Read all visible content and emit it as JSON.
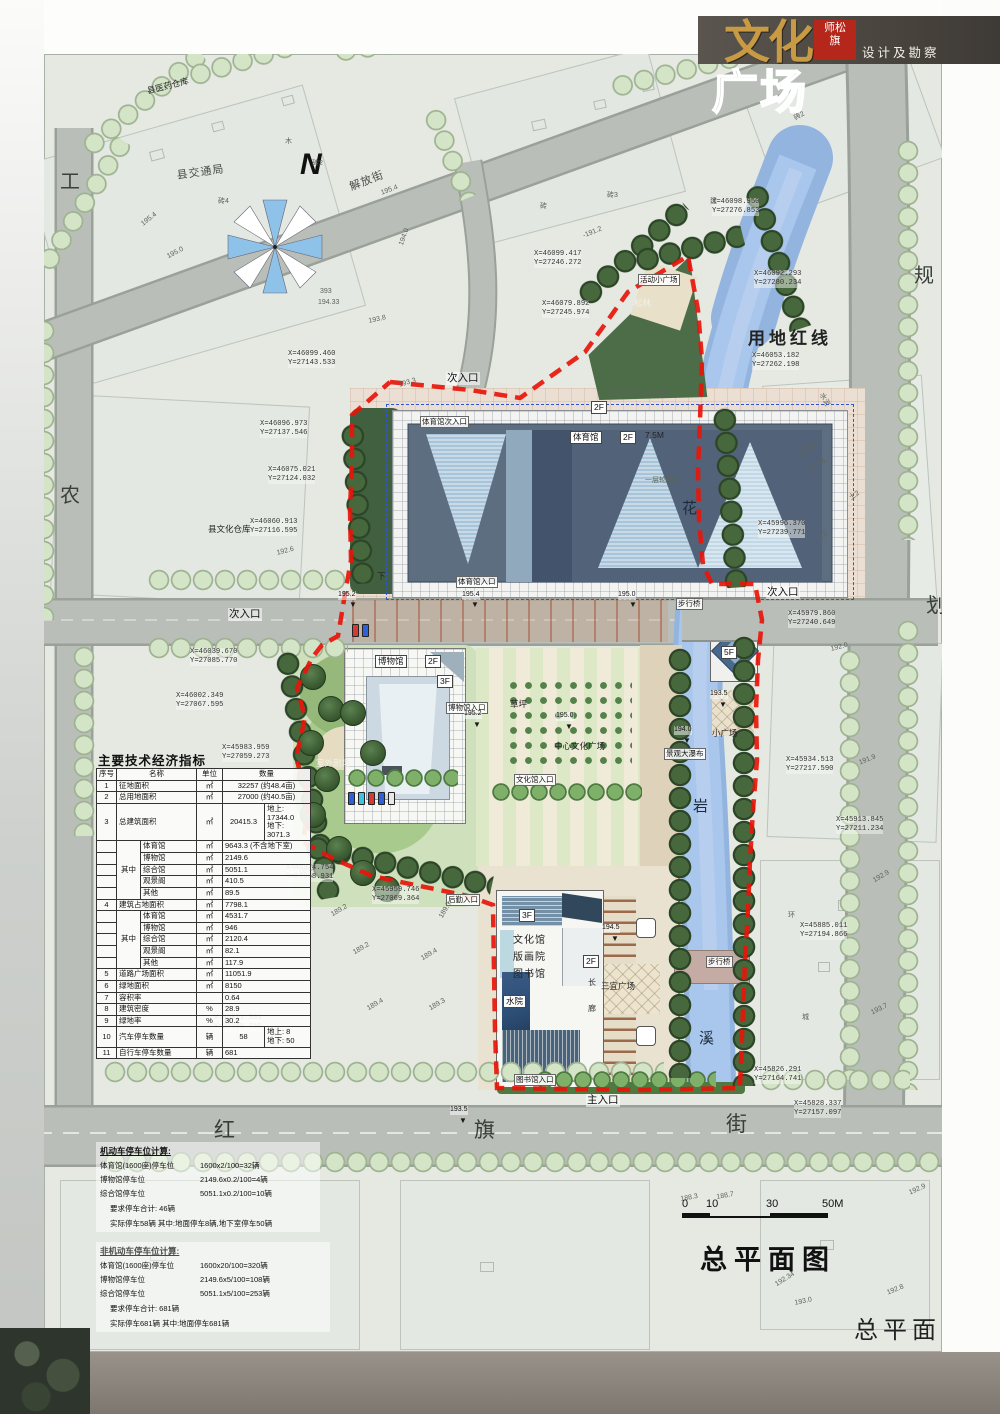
{
  "header": {
    "logo_top": "文化",
    "logo_bottom": "广场",
    "stamp": "师松\n旗",
    "subtitle": "设计及勘察"
  },
  "titles": {
    "plan_title": "总平面图",
    "margin_title": "总平面"
  },
  "scale": {
    "t0": "0",
    "t1": "10",
    "t2": "30",
    "t3": "50M"
  },
  "colors": {
    "boundary_red": "#e8150a",
    "river_blue": "#a9c6ec",
    "road_grey": "#b9bfb8",
    "tree_light": "#d4e4c6",
    "tree_dark": "#46683c",
    "logo_gold": "#c89a43",
    "stamp_red": "#b5271b",
    "header_bar": "#4f4a44"
  },
  "table": {
    "title": "主要技术经济指标",
    "rows": [
      [
        {
          "t": "序号"
        },
        {
          "t": "名称",
          "cs": 2
        },
        {
          "t": "单位"
        },
        {
          "t": "数量",
          "cs": 2
        }
      ],
      [
        {
          "t": "1"
        },
        {
          "t": "征地面积",
          "cs": 2,
          "cls": "l"
        },
        {
          "t": "㎡"
        },
        {
          "t": "32257 (约48.4亩)",
          "cs": 2
        }
      ],
      [
        {
          "t": "2"
        },
        {
          "t": "总用地面积",
          "cs": 2,
          "cls": "l"
        },
        {
          "t": "㎡"
        },
        {
          "t": "27000 (约40.5亩)",
          "cs": 2
        }
      ],
      [
        {
          "t": "3"
        },
        {
          "t": "总建筑面积",
          "cs": 2,
          "cls": "l"
        },
        {
          "t": "㎡"
        },
        {
          "t": "20415.3"
        },
        {
          "t": "地上: 17344.0\n地下: 3071.3",
          "cls": "l"
        }
      ],
      [
        {
          "t": ""
        },
        {
          "t": "其中",
          "rs": 5
        },
        {
          "t": "体育馆",
          "cls": "l"
        },
        {
          "t": "㎡"
        },
        {
          "t": "9643.3 (不含地下室)",
          "cs": 2,
          "cls": "l"
        }
      ],
      [
        {
          "t": ""
        },
        {
          "t": "博物馆",
          "cls": "l"
        },
        {
          "t": "㎡"
        },
        {
          "t": "2149.6",
          "cs": 2,
          "cls": "l"
        }
      ],
      [
        {
          "t": ""
        },
        {
          "t": "综合馆",
          "cls": "l"
        },
        {
          "t": "㎡"
        },
        {
          "t": "5051.1",
          "cs": 2,
          "cls": "l"
        }
      ],
      [
        {
          "t": ""
        },
        {
          "t": "观景阁",
          "cls": "l"
        },
        {
          "t": "㎡"
        },
        {
          "t": "410.5",
          "cs": 2,
          "cls": "l"
        }
      ],
      [
        {
          "t": ""
        },
        {
          "t": "其他",
          "cls": "l"
        },
        {
          "t": "㎡"
        },
        {
          "t": "89.5",
          "cs": 2,
          "cls": "l"
        }
      ],
      [
        {
          "t": "4"
        },
        {
          "t": "建筑占地面积",
          "cs": 2,
          "cls": "l"
        },
        {
          "t": "㎡"
        },
        {
          "t": "7798.1",
          "cs": 2,
          "cls": "l"
        }
      ],
      [
        {
          "t": ""
        },
        {
          "t": "其中",
          "rs": 5
        },
        {
          "t": "体育馆",
          "cls": "l"
        },
        {
          "t": "㎡"
        },
        {
          "t": "4531.7",
          "cs": 2,
          "cls": "l"
        }
      ],
      [
        {
          "t": ""
        },
        {
          "t": "博物馆",
          "cls": "l"
        },
        {
          "t": "㎡"
        },
        {
          "t": "946",
          "cs": 2,
          "cls": "l"
        }
      ],
      [
        {
          "t": ""
        },
        {
          "t": "综合馆",
          "cls": "l"
        },
        {
          "t": "㎡"
        },
        {
          "t": "2120.4",
          "cs": 2,
          "cls": "l"
        }
      ],
      [
        {
          "t": ""
        },
        {
          "t": "观景阁",
          "cls": "l"
        },
        {
          "t": "㎡"
        },
        {
          "t": "82.1",
          "cs": 2,
          "cls": "l"
        }
      ],
      [
        {
          "t": ""
        },
        {
          "t": "其他",
          "cls": "l"
        },
        {
          "t": "㎡"
        },
        {
          "t": "117.9",
          "cs": 2,
          "cls": "l"
        }
      ],
      [
        {
          "t": "5"
        },
        {
          "t": "道路广场面积",
          "cs": 2,
          "cls": "l"
        },
        {
          "t": "㎡"
        },
        {
          "t": "11051.9",
          "cs": 2,
          "cls": "l"
        }
      ],
      [
        {
          "t": "6"
        },
        {
          "t": "绿地面积",
          "cs": 2,
          "cls": "l"
        },
        {
          "t": "㎡"
        },
        {
          "t": "8150",
          "cs": 2,
          "cls": "l"
        }
      ],
      [
        {
          "t": "7"
        },
        {
          "t": "容积率",
          "cs": 2,
          "cls": "l"
        },
        {
          "t": ""
        },
        {
          "t": "0.64",
          "cs": 2,
          "cls": "l"
        }
      ],
      [
        {
          "t": "8"
        },
        {
          "t": "建筑密度",
          "cs": 2,
          "cls": "l"
        },
        {
          "t": "%"
        },
        {
          "t": "28.9",
          "cs": 2,
          "cls": "l"
        }
      ],
      [
        {
          "t": "9"
        },
        {
          "t": "绿地率",
          "cs": 2,
          "cls": "l"
        },
        {
          "t": "%"
        },
        {
          "t": "30.2",
          "cs": 2,
          "cls": "l"
        }
      ],
      [
        {
          "t": "10"
        },
        {
          "t": "汽车停车数量",
          "cs": 2,
          "cls": "l"
        },
        {
          "t": "辆"
        },
        {
          "t": "58"
        },
        {
          "t": "地上:  8\n地下:  50",
          "cls": "l"
        }
      ],
      [
        {
          "t": "11"
        },
        {
          "t": "自行车停车数量",
          "cs": 2,
          "cls": "l"
        },
        {
          "t": "辆"
        },
        {
          "t": "681",
          "cs": 2,
          "cls": "l"
        }
      ]
    ]
  },
  "parking": {
    "motor_title": "机动车停车位计算:",
    "motor": [
      [
        "体育馆(1600座)停车位",
        "1600x2/100=32辆"
      ],
      [
        "博物馆停车位",
        "2149.6x0.2/100=4辆"
      ],
      [
        "综合馆停车位",
        "5051.1x0.2/100=10辆"
      ]
    ],
    "motor_total": "要求停车合计:  46辆",
    "motor_actual": "实际停车58辆  其中:地面停车8辆,地下室停车50辆",
    "nonmotor_title": "非机动车停车位计算:",
    "nonmotor": [
      [
        "体育馆(1600座)停车位",
        "1600x20/100=320辆"
      ],
      [
        "博物馆停车位",
        "2149.6x5/100=108辆"
      ],
      [
        "综合馆停车位",
        "5051.1x5/100=253辆"
      ]
    ],
    "nonmotor_total": "要求停车合计:  681辆",
    "nonmotor_actual": "实际停车681辆  其中:地面停车681辆"
  },
  "annotations": [
    {
      "t": "工",
      "x": 60,
      "y": 170,
      "c": "mar"
    },
    {
      "t": "农",
      "x": 60,
      "y": 484,
      "c": "mar"
    },
    {
      "t": "规",
      "x": 914,
      "y": 264,
      "c": "mar"
    },
    {
      "t": "划",
      "x": 926,
      "y": 594,
      "c": "mar"
    },
    {
      "t": "红",
      "x": 214,
      "y": 1118,
      "c": "street"
    },
    {
      "t": "旗",
      "x": 474,
      "y": 1118,
      "c": "street"
    },
    {
      "t": "街",
      "x": 726,
      "y": 1112,
      "c": "street"
    },
    {
      "t": "解放街",
      "x": 348,
      "y": 182,
      "r": -21,
      "c": "rd"
    },
    {
      "t": "N",
      "x": 300,
      "y": 146,
      "c": "north",
      "n": "north-letter"
    },
    {
      "t": "县交通局",
      "x": 176,
      "y": 170,
      "r": -8,
      "c": "rd"
    },
    {
      "t": "县医药仓库",
      "x": 146,
      "y": 86,
      "r": -14,
      "c": "s9"
    },
    {
      "t": "县文化仓库",
      "x": 208,
      "y": 524,
      "c": "s9"
    },
    {
      "t": "用地红线",
      "x": 748,
      "y": 328,
      "c": "big",
      "n": "red-line-label"
    },
    {
      "t": "次入口",
      "x": 446,
      "y": 372,
      "c": "ent"
    },
    {
      "t": "次入口",
      "x": 228,
      "y": 608,
      "c": "ent"
    },
    {
      "t": "次入口",
      "x": 766,
      "y": 586,
      "c": "ent"
    },
    {
      "t": "主入口",
      "x": 586,
      "y": 1094,
      "c": "ent"
    },
    {
      "t": "体育馆次入口",
      "x": 420,
      "y": 416,
      "c": "tb"
    },
    {
      "t": "体育馆入口",
      "x": 456,
      "y": 576,
      "c": "tb"
    },
    {
      "t": "博物馆入口",
      "x": 446,
      "y": 702,
      "c": "tb"
    },
    {
      "t": "文化馆入口",
      "x": 514,
      "y": 774,
      "c": "tb"
    },
    {
      "t": "图书馆入口",
      "x": 514,
      "y": 1074,
      "c": "tb"
    },
    {
      "t": "后勤入口",
      "x": 446,
      "y": 894,
      "c": "tb"
    },
    {
      "t": "步行桥",
      "x": 676,
      "y": 598,
      "c": "tb"
    },
    {
      "t": "步行桥",
      "x": 706,
      "y": 956,
      "c": "tb"
    },
    {
      "t": "景观大瀑布",
      "x": 664,
      "y": 748,
      "c": "tb"
    },
    {
      "t": "活动小广场",
      "x": 638,
      "y": 274,
      "c": "tb"
    },
    {
      "t": "松林",
      "x": 634,
      "y": 298,
      "c": "s9w"
    },
    {
      "t": "体育馆",
      "x": 570,
      "y": 431,
      "c": "box"
    },
    {
      "t": "2F",
      "x": 620,
      "y": 431,
      "c": "box"
    },
    {
      "t": "7.5M",
      "x": 645,
      "y": 430,
      "c": "s9"
    },
    {
      "t": "2F",
      "x": 591,
      "y": 401,
      "c": "box"
    },
    {
      "t": "地下室顶面线 9.5M",
      "x": 608,
      "y": 390,
      "c": "s"
    },
    {
      "t": "一层轮廓线",
      "x": 645,
      "y": 477,
      "c": "s"
    },
    {
      "t": "下",
      "x": 377,
      "y": 571,
      "c": "s9"
    },
    {
      "t": "博物馆",
      "x": 375,
      "y": 655,
      "c": "box"
    },
    {
      "t": "2F",
      "x": 425,
      "y": 655,
      "c": "box"
    },
    {
      "t": "3F",
      "x": 437,
      "y": 675,
      "c": "box"
    },
    {
      "t": "草坪",
      "x": 510,
      "y": 699,
      "c": "s9"
    },
    {
      "t": "室外剧场",
      "x": 316,
      "y": 758,
      "c": "s9w"
    },
    {
      "t": "中心文化广场",
      "x": 554,
      "y": 741,
      "c": "s9"
    },
    {
      "t": "文化馆",
      "x": 513,
      "y": 935,
      "c": "bldl"
    },
    {
      "t": "版画院",
      "x": 513,
      "y": 952,
      "c": "bldl"
    },
    {
      "t": "图书馆",
      "x": 513,
      "y": 969,
      "c": "bldl"
    },
    {
      "t": "3F",
      "x": 519,
      "y": 909,
      "c": "box"
    },
    {
      "t": "2F",
      "x": 583,
      "y": 955,
      "c": "box"
    },
    {
      "t": "水院",
      "x": 503,
      "y": 995,
      "c": "box"
    },
    {
      "t": "三宜广场",
      "x": 601,
      "y": 981,
      "c": "s9"
    },
    {
      "t": "小广场",
      "x": 712,
      "y": 728,
      "c": "s9"
    },
    {
      "t": "5F",
      "x": 721,
      "y": 646,
      "c": "box"
    },
    {
      "t": "长",
      "x": 588,
      "y": 978,
      "c": "s8"
    },
    {
      "t": "廊",
      "x": 588,
      "y": 1004,
      "c": "s8"
    },
    {
      "t": "花",
      "x": 682,
      "y": 500,
      "c": "river"
    },
    {
      "t": "岩",
      "x": 693,
      "y": 798,
      "c": "river"
    },
    {
      "t": "溪",
      "x": 699,
      "y": 1030,
      "c": "river"
    },
    {
      "t": "环",
      "x": 788,
      "y": 912,
      "c": "s"
    },
    {
      "t": "城",
      "x": 802,
      "y": 1014,
      "c": "s"
    },
    {
      "t": "195.2",
      "x": 338,
      "y": 591,
      "c": "lv"
    },
    {
      "t": "▼",
      "x": 349,
      "y": 600,
      "c": "mk"
    },
    {
      "t": "195.4",
      "x": 462,
      "y": 591,
      "c": "lv"
    },
    {
      "t": "▼",
      "x": 471,
      "y": 600,
      "c": "mk"
    },
    {
      "t": "195.0",
      "x": 618,
      "y": 591,
      "c": "lv"
    },
    {
      "t": "▼",
      "x": 629,
      "y": 600,
      "c": "mk"
    },
    {
      "t": "195.2",
      "x": 464,
      "y": 710,
      "c": "lv"
    },
    {
      "t": "▼",
      "x": 473,
      "y": 720,
      "c": "mk"
    },
    {
      "t": "195.0",
      "x": 556,
      "y": 712,
      "c": "lv"
    },
    {
      "t": "▼",
      "x": 565,
      "y": 722,
      "c": "mk"
    },
    {
      "t": "194.5",
      "x": 602,
      "y": 924,
      "c": "lv"
    },
    {
      "t": "▼",
      "x": 611,
      "y": 934,
      "c": "mk"
    },
    {
      "t": "193.5",
      "x": 710,
      "y": 690,
      "c": "lv"
    },
    {
      "t": "▼",
      "x": 719,
      "y": 700,
      "c": "mk"
    },
    {
      "t": "194.0",
      "x": 674,
      "y": 726,
      "c": "lv"
    },
    {
      "t": "▼",
      "x": 683,
      "y": 736,
      "c": "mk"
    },
    {
      "t": "193.5",
      "x": 450,
      "y": 1106,
      "c": "lv"
    },
    {
      "t": "▼",
      "x": 459,
      "y": 1116,
      "c": "mk"
    },
    {
      "t": "X=46098.950\nY=27276.853",
      "x": 712,
      "y": 198,
      "c": "c"
    },
    {
      "t": "X=46099.417\nY=27246.272",
      "x": 534,
      "y": 250,
      "c": "c"
    },
    {
      "t": "X=46092.293\nY=27280.234",
      "x": 754,
      "y": 270,
      "c": "c"
    },
    {
      "t": "X=46079.892\nY=27245.974",
      "x": 542,
      "y": 300,
      "c": "c"
    },
    {
      "t": "X=46053.182\nY=27262.198",
      "x": 752,
      "y": 352,
      "c": "c"
    },
    {
      "t": "X=46099.460\nY=27143.533",
      "x": 288,
      "y": 350,
      "c": "c"
    },
    {
      "t": "X=46096.973\nY=27137.546",
      "x": 260,
      "y": 420,
      "c": "c"
    },
    {
      "t": "X=46075.021\nY=27124.032",
      "x": 268,
      "y": 466,
      "c": "c"
    },
    {
      "t": "X=46060.913\nY=27116.595",
      "x": 250,
      "y": 518,
      "c": "c"
    },
    {
      "t": "X=46039.670\nY=27085.770",
      "x": 190,
      "y": 648,
      "c": "c"
    },
    {
      "t": "X=46002.349\nY=27067.595",
      "x": 176,
      "y": 692,
      "c": "c"
    },
    {
      "t": "X=45983.959\nY=27059.273",
      "x": 222,
      "y": 744,
      "c": "c"
    },
    {
      "t": "X=45974.754\nY=27068.931",
      "x": 286,
      "y": 864,
      "c": "c"
    },
    {
      "t": "X=45959.746\nY=27069.364",
      "x": 372,
      "y": 886,
      "c": "c"
    },
    {
      "t": "X=45996.370\nY=27239.771",
      "x": 758,
      "y": 520,
      "c": "c"
    },
    {
      "t": "X=45979.860\nY=27240.649",
      "x": 788,
      "y": 610,
      "c": "c"
    },
    {
      "t": "X=45934.513\nY=27217.590",
      "x": 786,
      "y": 756,
      "c": "c"
    },
    {
      "t": "X=45913.845\nY=27211.234",
      "x": 836,
      "y": 816,
      "c": "c"
    },
    {
      "t": "X=45885.011\nY=27194.866",
      "x": 800,
      "y": 922,
      "c": "c"
    },
    {
      "t": "X=45871.385\nY=27085.755",
      "x": 214,
      "y": 1014,
      "c": "c"
    },
    {
      "t": "X=45826.291\nY=27164.741",
      "x": 754,
      "y": 1066,
      "c": "c"
    },
    {
      "t": "X=45828.337\nY=27157.097",
      "x": 794,
      "y": 1100,
      "c": "c"
    },
    {
      "t": "砖4",
      "x": 218,
      "y": 198,
      "c": "s"
    },
    {
      "t": "砖2",
      "x": 312,
      "y": 160,
      "c": "s"
    },
    {
      "t": "木",
      "x": 285,
      "y": 138,
      "c": "s"
    },
    {
      "t": "195.4",
      "x": 140,
      "y": 222,
      "r": -38,
      "c": "s"
    },
    {
      "t": "195.0",
      "x": 166,
      "y": 254,
      "r": -28,
      "c": "s"
    },
    {
      "t": "195.4",
      "x": 380,
      "y": 190,
      "r": -20,
      "c": "s"
    },
    {
      "t": "194.0",
      "x": 398,
      "y": 244,
      "r": -70,
      "c": "s"
    },
    {
      "t": "393",
      "x": 320,
      "y": 288,
      "c": "s"
    },
    {
      "t": "194.33",
      "x": 318,
      "y": 299,
      "c": "s"
    },
    {
      "t": "193.8",
      "x": 368,
      "y": 318,
      "r": -12,
      "c": "s"
    },
    {
      "t": "砖",
      "x": 540,
      "y": 203,
      "c": "s"
    },
    {
      "t": "砖3",
      "x": 607,
      "y": 192,
      "c": "s"
    },
    {
      "t": "建",
      "x": 710,
      "y": 198,
      "c": "s"
    },
    {
      "t": "-191.2",
      "x": 582,
      "y": 233,
      "r": -22,
      "c": "s"
    },
    {
      "t": "砖2",
      "x": 793,
      "y": 116,
      "r": -30,
      "c": "s"
    },
    {
      "t": "192.6",
      "x": 276,
      "y": 550,
      "r": -14,
      "c": "s"
    },
    {
      "t": "193.3",
      "x": 398,
      "y": 382,
      "r": -16,
      "c": "s"
    },
    {
      "t": "192.0",
      "x": 830,
      "y": 646,
      "r": -14,
      "c": "s"
    },
    {
      "t": "191.9",
      "x": 858,
      "y": 760,
      "r": -22,
      "c": "s"
    },
    {
      "t": "192.95",
      "x": 806,
      "y": 470,
      "r": -36,
      "c": "s"
    },
    {
      "t": "4-D339",
      "x": 798,
      "y": 452,
      "r": -36,
      "c": "s"
    },
    {
      "t": "水泥",
      "x": 824,
      "y": 392,
      "r": 62,
      "c": "s"
    },
    {
      "t": "土2",
      "x": 848,
      "y": 496,
      "r": -35,
      "c": "s"
    },
    {
      "t": "土2",
      "x": 816,
      "y": 536,
      "r": -35,
      "c": "s"
    },
    {
      "t": "192.9",
      "x": 872,
      "y": 878,
      "r": -30,
      "c": "s"
    },
    {
      "t": "193.7",
      "x": 870,
      "y": 1010,
      "r": -26,
      "c": "s"
    },
    {
      "t": "188.3",
      "x": 680,
      "y": 1196,
      "r": -10,
      "c": "s"
    },
    {
      "t": "188.7",
      "x": 716,
      "y": 1194,
      "r": -10,
      "c": "s"
    },
    {
      "t": "192.34",
      "x": 774,
      "y": 1282,
      "r": -32,
      "c": "s"
    },
    {
      "t": "193.0",
      "x": 794,
      "y": 1300,
      "r": -12,
      "c": "s"
    },
    {
      "t": "192.8",
      "x": 886,
      "y": 1290,
      "r": -22,
      "c": "s"
    },
    {
      "t": "192.9",
      "x": 908,
      "y": 1190,
      "r": -24,
      "c": "s"
    },
    {
      "t": "189.2",
      "x": 298,
      "y": 870,
      "r": -20,
      "c": "s"
    },
    {
      "t": "189.2",
      "x": 330,
      "y": 912,
      "r": -30,
      "c": "s"
    },
    {
      "t": "189.2",
      "x": 352,
      "y": 950,
      "r": -30,
      "c": "s"
    },
    {
      "t": "189.3",
      "x": 438,
      "y": 916,
      "r": -60,
      "c": "s"
    },
    {
      "t": "189.4",
      "x": 420,
      "y": 956,
      "r": -30,
      "c": "s"
    },
    {
      "t": "189.4",
      "x": 366,
      "y": 1006,
      "r": -30,
      "c": "s"
    },
    {
      "t": "189.3",
      "x": 428,
      "y": 1006,
      "r": -30,
      "c": "s"
    }
  ]
}
